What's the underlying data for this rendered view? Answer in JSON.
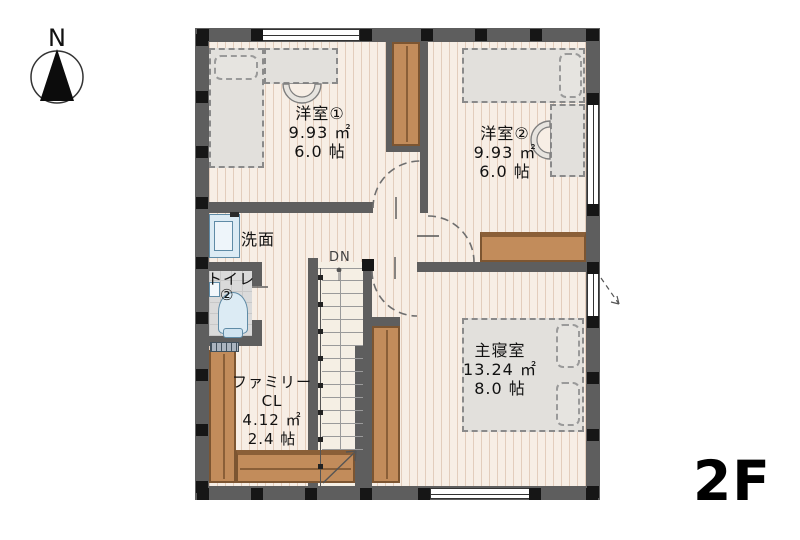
{
  "compass": {
    "label": "N"
  },
  "floor_label": "2F",
  "stairs": {
    "label": "DN"
  },
  "rooms": {
    "room1": {
      "name": "洋室①",
      "area_m2": "9.93 ㎡",
      "area_jo": "6.0 帖"
    },
    "room2": {
      "name": "洋室②",
      "area_m2": "9.93 ㎡",
      "area_jo": "6.0 帖"
    },
    "master": {
      "name": "主寝室",
      "area_m2": "13.24 ㎡",
      "area_jo": "8.0 帖"
    },
    "washroom": {
      "name": "洗面"
    },
    "toilet": {
      "name": "トイレ",
      "number": "②"
    },
    "family_closet": {
      "line1": "ファミリー",
      "line2": "CL",
      "area_m2": "4.12 ㎡",
      "area_jo": "2.4 帖"
    }
  },
  "colors": {
    "wall": "#5e5e5e",
    "pillar": "#161616",
    "closet_wood": "#c28c5b",
    "floor_wood": "#f7eee5",
    "fixture_blue": "#dcebf4",
    "text": "#111111"
  }
}
